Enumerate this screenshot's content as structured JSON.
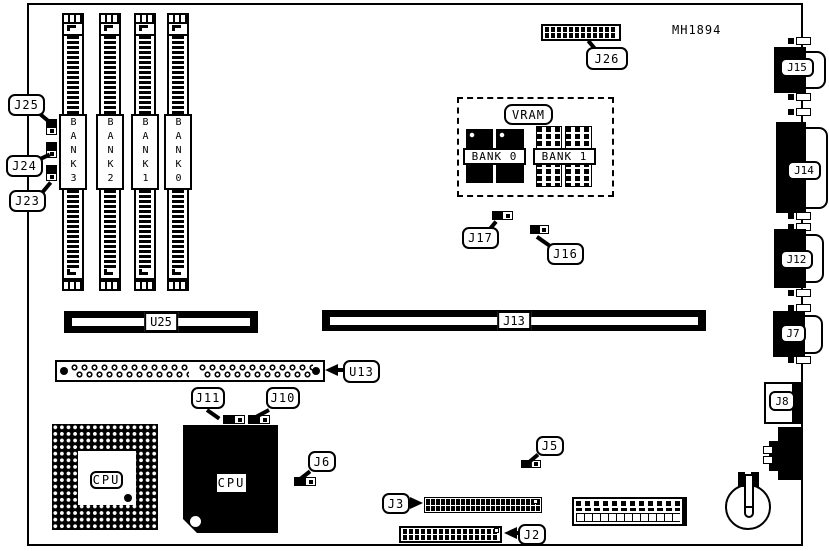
{
  "diagram": {
    "part_number": "MH1894",
    "simm": {
      "banks": [
        {
          "label": "BANK3"
        },
        {
          "label": "BANK2"
        },
        {
          "label": "BANK1"
        },
        {
          "label": "BANK0"
        }
      ]
    },
    "jumpers": {
      "j25": "J25",
      "j24": "J24",
      "j23": "J23",
      "j17": "J17",
      "j16": "J16",
      "j11": "J11",
      "j10": "J10",
      "j6": "J6",
      "j5": "J5"
    },
    "connectors": {
      "j26": "J26",
      "j13": "J13",
      "j3": "J3",
      "j2": "J2",
      "j15": "J15",
      "j14": "J14",
      "j12": "J12",
      "j7": "J7",
      "j8": "J8"
    },
    "chips": {
      "u25": "U25",
      "u13": "U13",
      "cpu_socket": "CPU",
      "cpu_chip": "CPU"
    },
    "vram": {
      "title": "VRAM",
      "bank0": "BANK 0",
      "bank1": "BANK 1"
    }
  }
}
